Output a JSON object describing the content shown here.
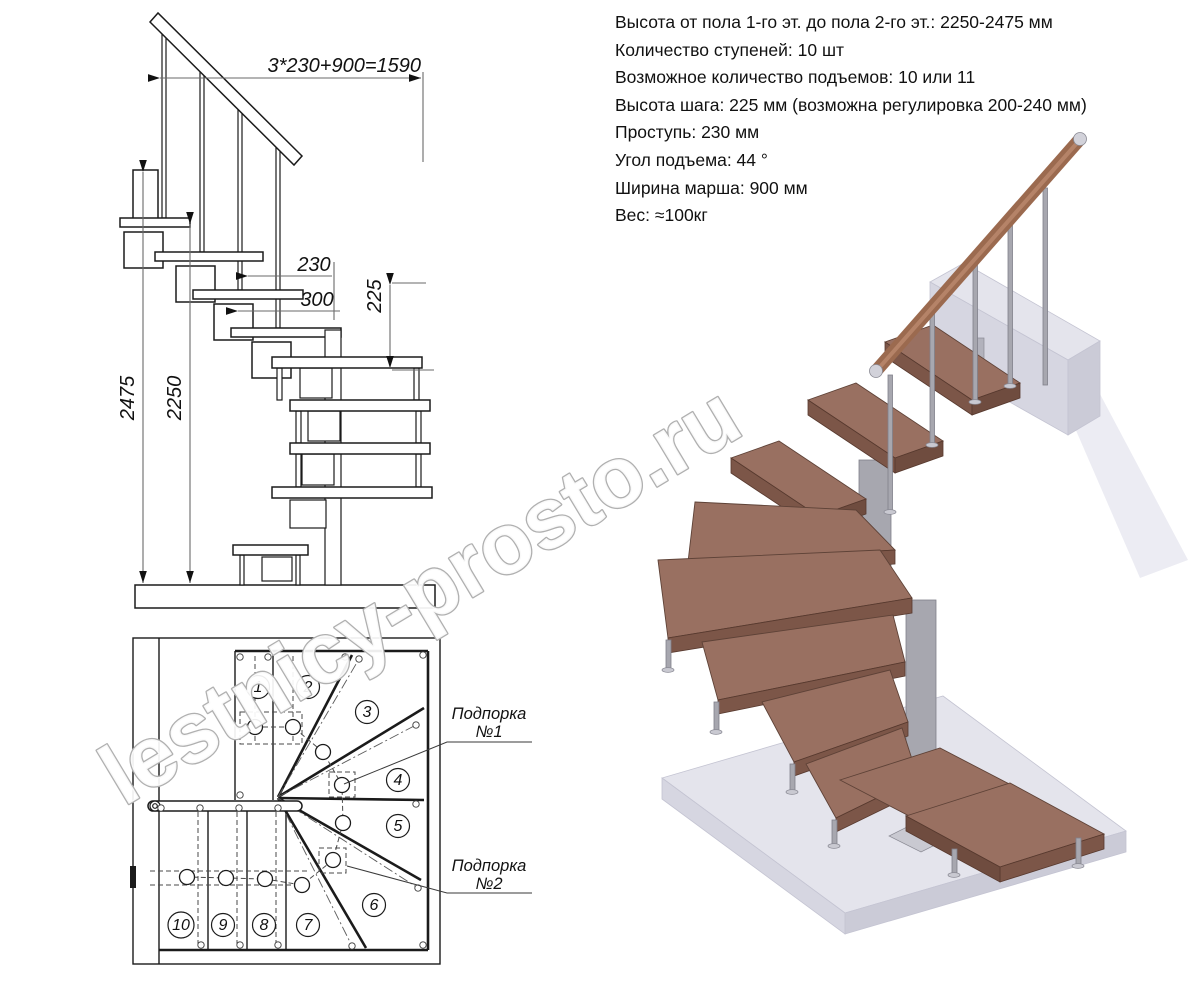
{
  "specs": {
    "lines": [
      "Высота от пола 1-го эт. до пола 2-го эт.: 2250-2475 мм",
      "Количество ступеней: 10 шт",
      "Возможное количество подъемов: 10 или 11",
      "Высота шага: 225 мм (возможна регулировка 200-240 мм)",
      "Проступь: 230 мм",
      "Угол подъема: 44 °",
      "Ширина марша: 900 мм",
      "Вес: ≈100кг"
    ]
  },
  "elevation": {
    "dim_formula": "3*230+900=1590",
    "dim_tread": "230",
    "dim_platform": "300",
    "dim_rise": "225",
    "dim_total_height": "2475",
    "dim_clear_height": "2250"
  },
  "plan": {
    "step_numbers": [
      "1",
      "2",
      "3",
      "4",
      "5",
      "6",
      "7",
      "8",
      "9",
      "10"
    ],
    "support1": {
      "line1": "Подпорка",
      "line2": "№1"
    },
    "support2": {
      "line1": "Подпорка",
      "line2": "№2"
    }
  },
  "watermark": {
    "text": "lestnicy-prosto.ru"
  },
  "colors": {
    "wood_top": "#997061",
    "wood_front": "#7c5648",
    "metal": "#a7a7af",
    "floor_gray": "#d6d6e1",
    "handrail_wood": "#9b6a4f",
    "drawing_line": "#1b1b1b",
    "watermark_outline": "#b0b0b0"
  }
}
